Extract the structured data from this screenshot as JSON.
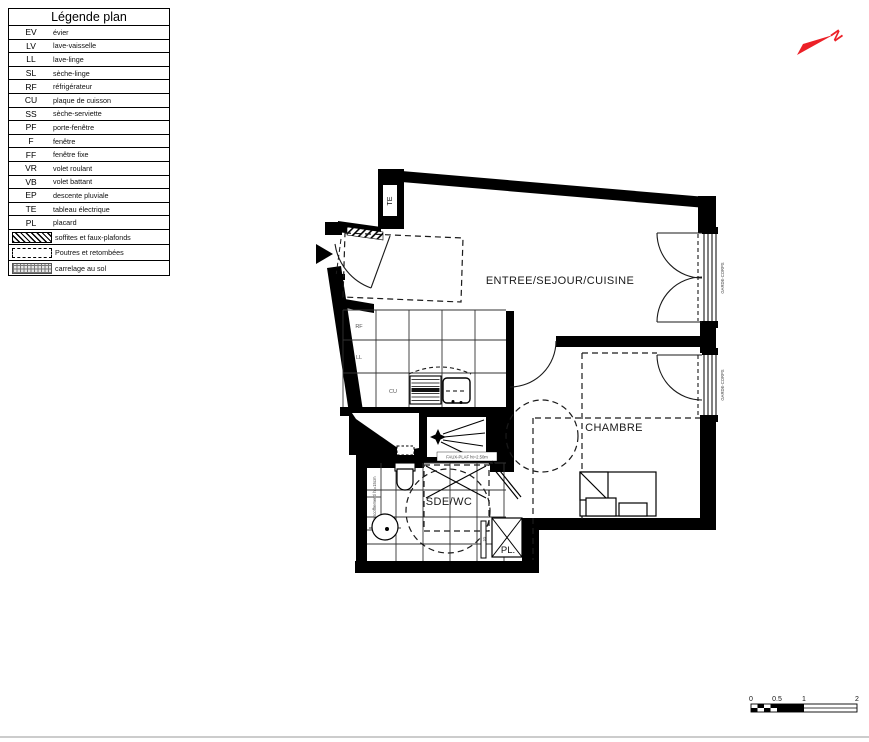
{
  "legend": {
    "title": "Légende plan",
    "items": [
      {
        "abbr": "EV",
        "label": "évier"
      },
      {
        "abbr": "LV",
        "label": "lave-vaisselle"
      },
      {
        "abbr": "LL",
        "label": "lave-linge"
      },
      {
        "abbr": "SL",
        "label": "sèche-linge"
      },
      {
        "abbr": "RF",
        "label": "réfrigérateur"
      },
      {
        "abbr": "CU",
        "label": "plaque de cuisson"
      },
      {
        "abbr": "SS",
        "label": "sèche-serviette"
      },
      {
        "abbr": "PF",
        "label": "porte-fenêtre"
      },
      {
        "abbr": "F",
        "label": "fenêtre"
      },
      {
        "abbr": "FF",
        "label": "fenêtre fixe"
      },
      {
        "abbr": "VR",
        "label": "volet roulant"
      },
      {
        "abbr": "VB",
        "label": "volet battant"
      },
      {
        "abbr": "EP",
        "label": "descente pluviale"
      },
      {
        "abbr": "TE",
        "label": "tableau électrique"
      },
      {
        "abbr": "PL",
        "label": "placard"
      }
    ],
    "swatches": [
      {
        "label": "soffites et faux-plafonds"
      },
      {
        "label": "Poutres et retombées"
      },
      {
        "label": "carrelage au sol"
      }
    ]
  },
  "plan": {
    "room_entree": "ENTREE/SEJOUR/CUISINE",
    "room_chambre": "CHAMBRE",
    "room_sde": "SDE/WC",
    "label_pl": "PL.",
    "label_te": "TE",
    "label_rf": "RF",
    "label_ll": "LL",
    "label_cu": "CU",
    "label_ss": "SS",
    "garde_corps": "GARDE-CORPS",
    "encoffrement": "encoffrement/ ht=15cm",
    "faux_plaf": "FAUX-PLAF ht=2.50m"
  },
  "north": {
    "letter": "N",
    "color": "#ec2027"
  },
  "scale": {
    "t0": "0",
    "t05": "0.5",
    "t1": "1",
    "t2": "2"
  }
}
